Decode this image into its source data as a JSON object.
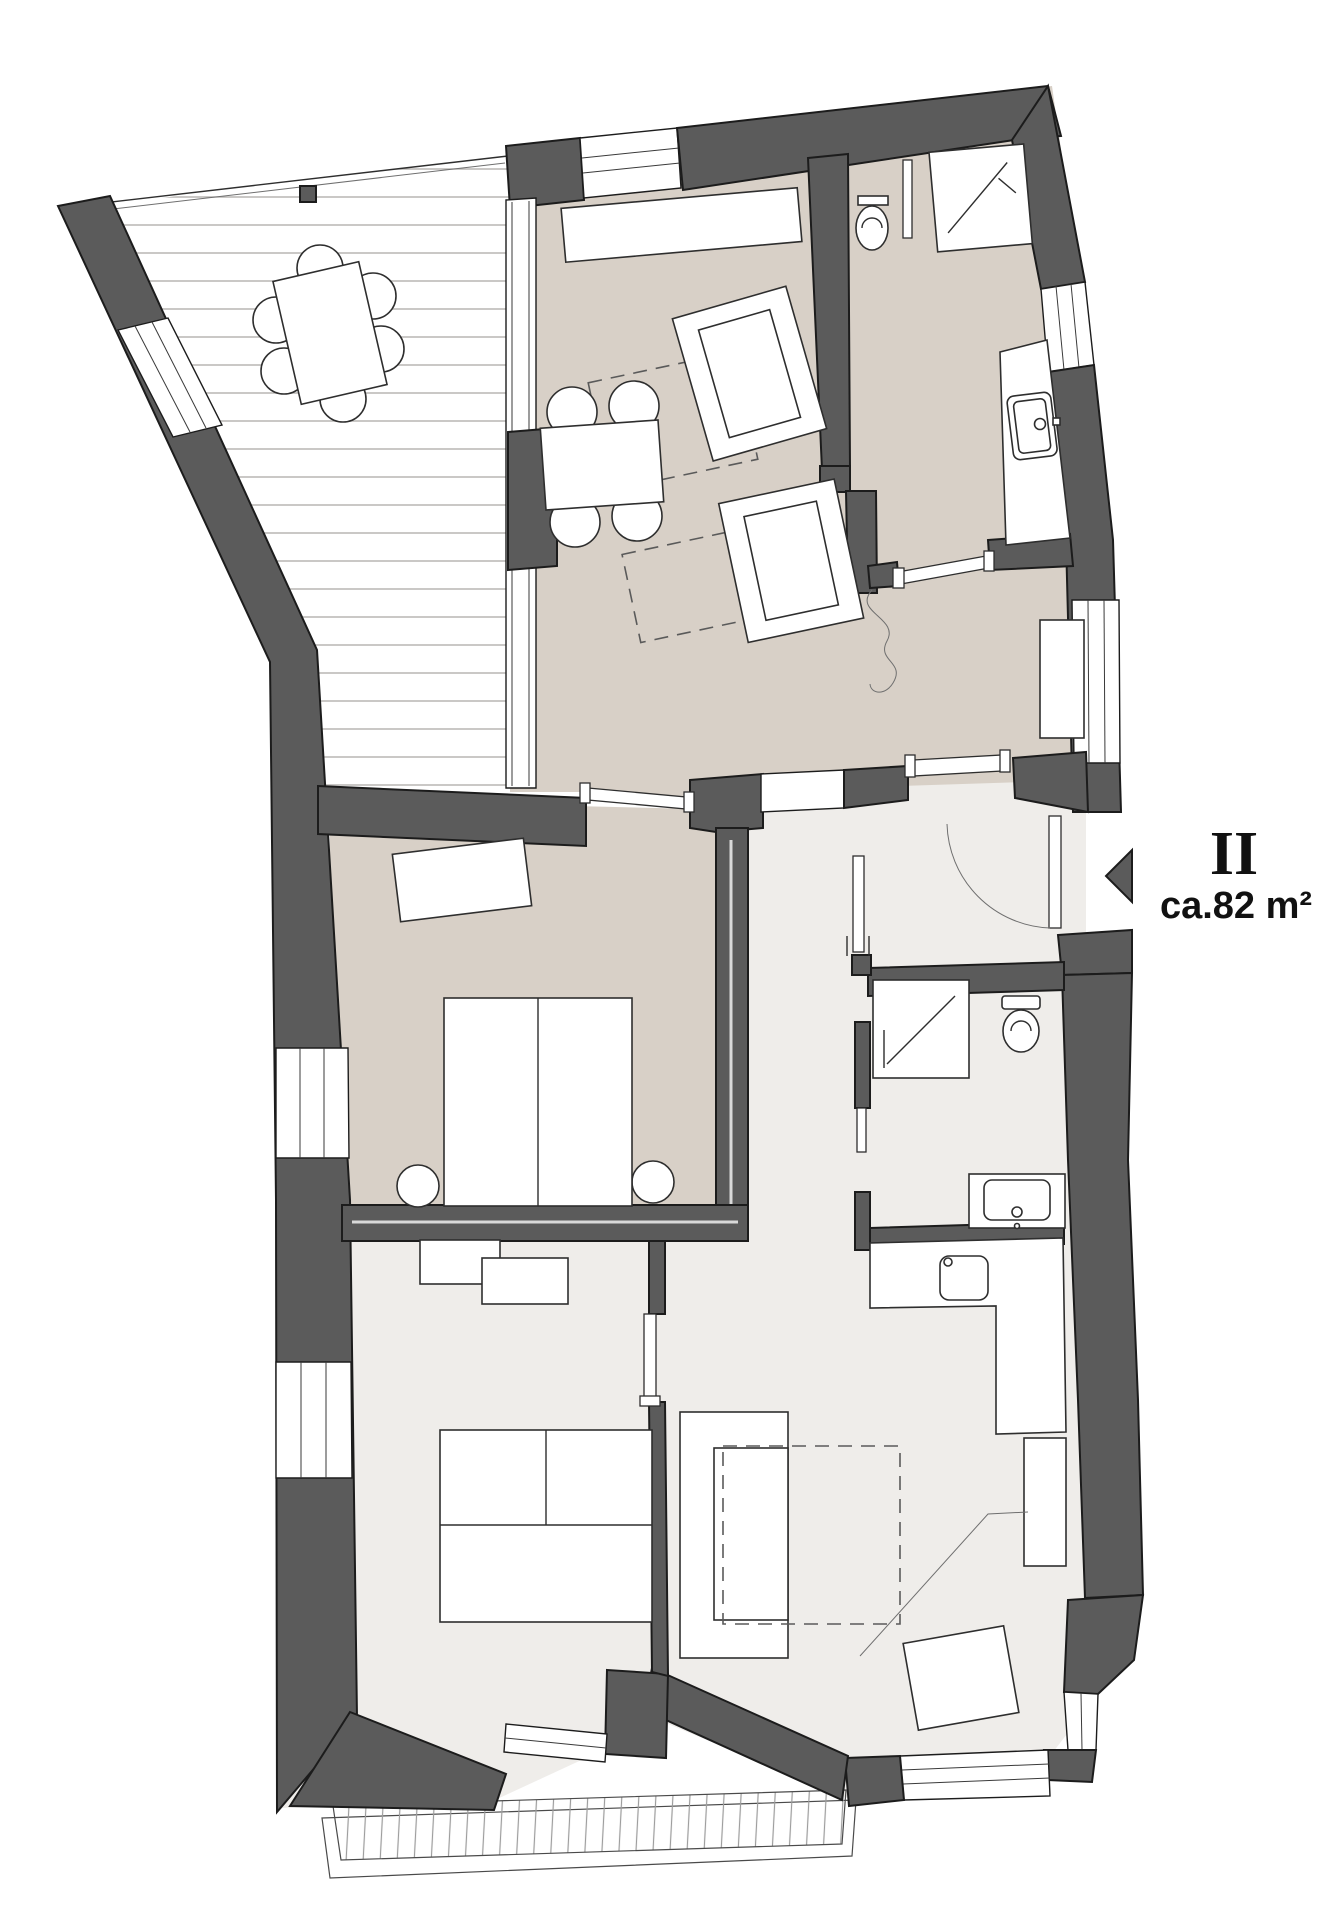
{
  "label": {
    "unit": "II",
    "area": "ca.82 m²"
  },
  "icons": {
    "entry_arrow": "left-pointing-triangle"
  },
  "colors": {
    "wall": "#5b5b5b",
    "floor_beige": "#d8d0c7",
    "floor_light": "#efedea",
    "outline": "#1c1c1c",
    "plank_line": "#b3b1ae",
    "text": "#111111"
  }
}
